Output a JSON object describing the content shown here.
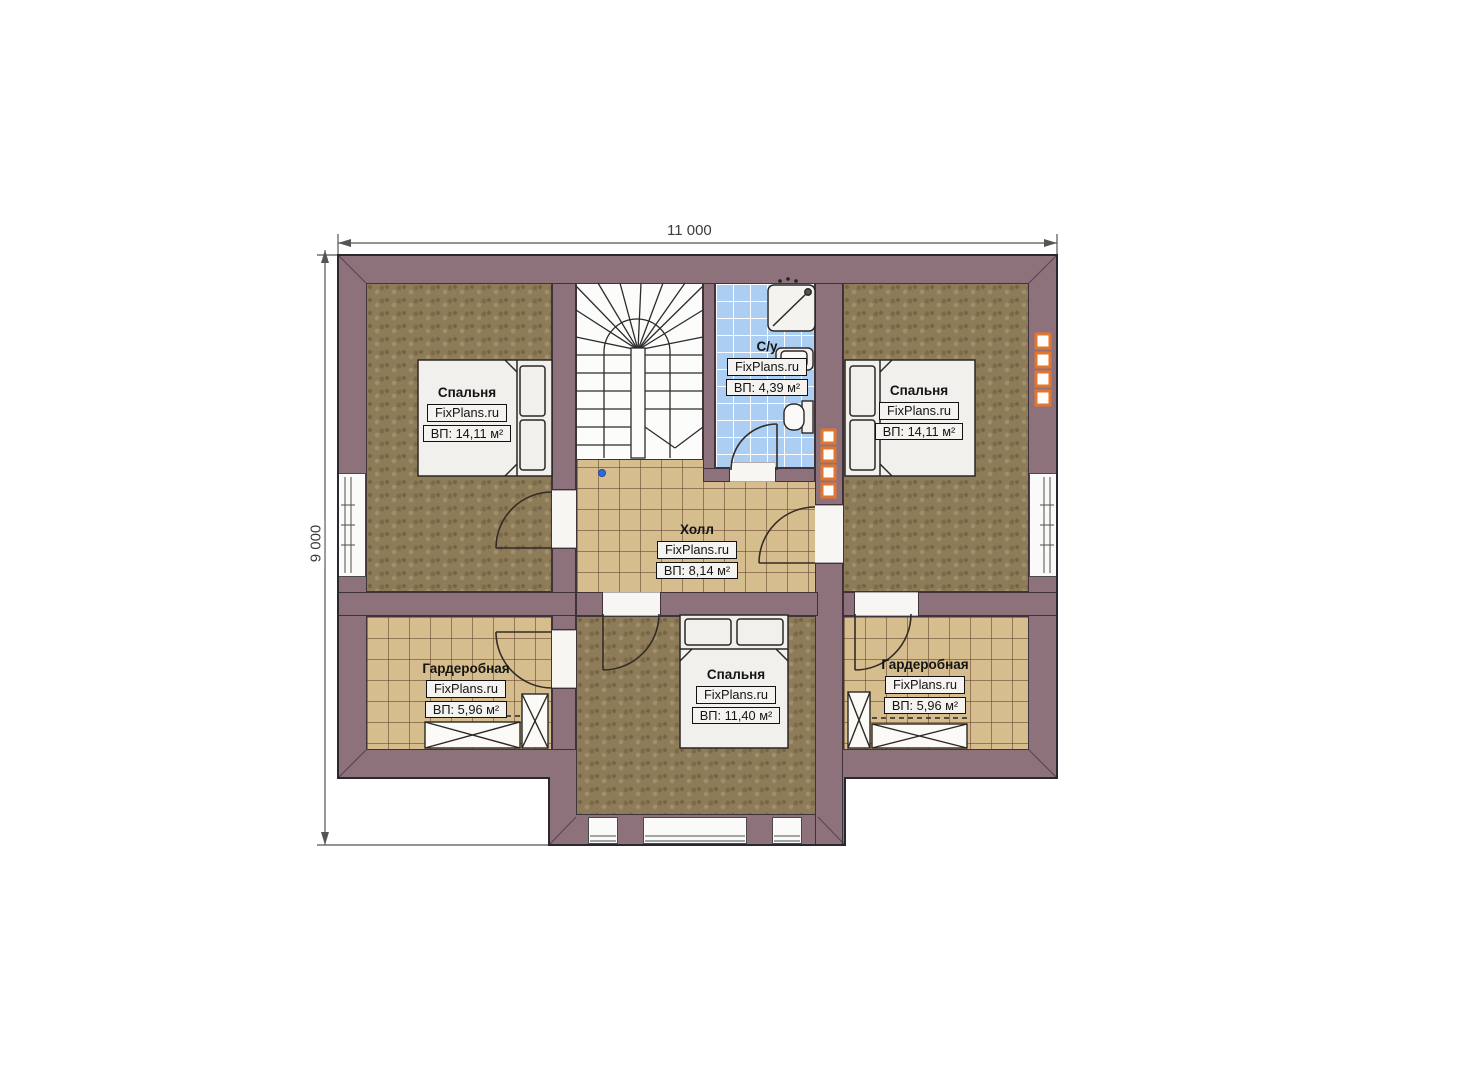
{
  "plan": {
    "watermark": "FixPlans.ru",
    "dimensions": {
      "top": "11 000",
      "left": "9 000"
    },
    "rooms": [
      {
        "id": "bedroom-top-left",
        "name": "Спальня",
        "area": "ВП: 14,11 м²"
      },
      {
        "id": "bedroom-top-right",
        "name": "Спальня",
        "area": "ВП: 14,11 м²"
      },
      {
        "id": "bathroom",
        "name": "С/у",
        "area": "ВП: 4,39 м²"
      },
      {
        "id": "hall",
        "name": "Холл",
        "area": "ВП: 8,14 м²"
      },
      {
        "id": "wardrobe-left",
        "name": "Гардеробная",
        "area": "ВП: 5,96 м²"
      },
      {
        "id": "wardrobe-right",
        "name": "Гардеробная",
        "area": "ВП: 5,96 м²"
      },
      {
        "id": "bedroom-bottom",
        "name": "Спальня",
        "area": "ВП: 11,40 м²"
      }
    ],
    "colors": {
      "wall": "#8d727c",
      "carpet": "#8e7c59",
      "floor_tile": "#d6bd8d",
      "bathroom_tile": "#abcef2",
      "flue_accent": "#e2762e"
    }
  }
}
